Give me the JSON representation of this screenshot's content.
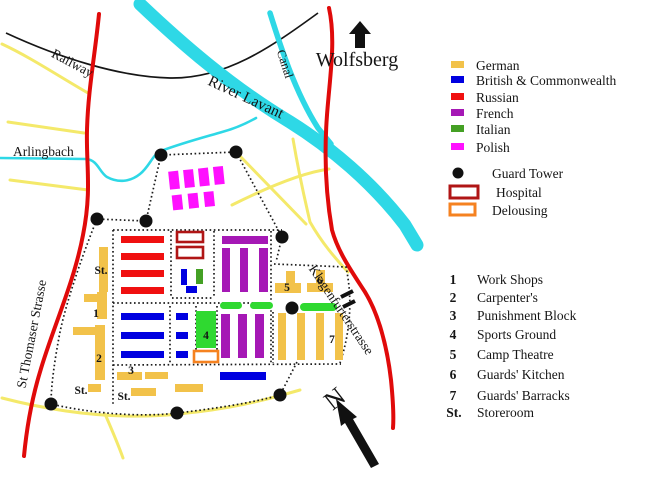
{
  "map_labels": {
    "railway": "Railway",
    "arlingbach": "Arlingbach",
    "st_thomaser": "St Thomaser Strasse",
    "river": "River Lavant",
    "canal": "Canal",
    "wolfsberg": "Wolfsberg",
    "klagenfurter": "Klagenfurterstrasse",
    "north": "N"
  },
  "map_markers": {
    "st_upper": "St.",
    "st_bottom_left": "St.",
    "st_bottom_mid": "St.",
    "n1": "1",
    "n2": "2",
    "n3": "3",
    "n4": "4",
    "n5": "5",
    "n6": "6",
    "n7": "7"
  },
  "colors": {
    "german": "#F2C24A",
    "british": "#0000E0",
    "russian": "#F01010",
    "french": "#A518B5",
    "italian": "#44A024",
    "italian_bright": "#2FD930",
    "polish": "#FF10FF",
    "hospital_border": "#B01515",
    "delousing_border": "#F58220",
    "road_red": "#E00A0A",
    "road_yellow": "#F4E96A",
    "water": "#2ED8E6",
    "marker_red": "#C84040",
    "tower_black": "#111111"
  },
  "legend": {
    "nationalities": [
      {
        "label": "German",
        "color": "#F2C24A"
      },
      {
        "label": "British & Commonwealth",
        "color": "#0000E0"
      },
      {
        "label": "Russian",
        "color": "#F01010"
      },
      {
        "label": "French",
        "color": "#A518B5"
      },
      {
        "label": "Italian",
        "color": "#44A024"
      },
      {
        "label": "Polish",
        "color": "#FF10FF"
      }
    ],
    "symbols": [
      {
        "label": "Guard Tower"
      },
      {
        "label": "Hospital"
      },
      {
        "label": "Delousing"
      }
    ]
  },
  "key": {
    "items": [
      {
        "num": "1",
        "label": "Work Shops",
        "num_color": "#C84040"
      },
      {
        "num": "2",
        "label": "Carpenter's",
        "num_color": "#C84040"
      },
      {
        "num": "3",
        "label": "Punishment Block",
        "num_color": "#C84040"
      },
      {
        "num": "4",
        "label": "Sports Ground",
        "num_color": "#C84040"
      },
      {
        "num": "5",
        "label": "Camp Theatre",
        "num_color": "#C84040"
      },
      {
        "num": "6",
        "label": "Guards' Kitchen",
        "num_color": "#C84040"
      },
      {
        "num": "7",
        "label": "Guards' Barracks",
        "num_color": "#C84040"
      },
      {
        "num": "St.",
        "label": "Storeroom",
        "num_color": "#151515"
      }
    ]
  }
}
